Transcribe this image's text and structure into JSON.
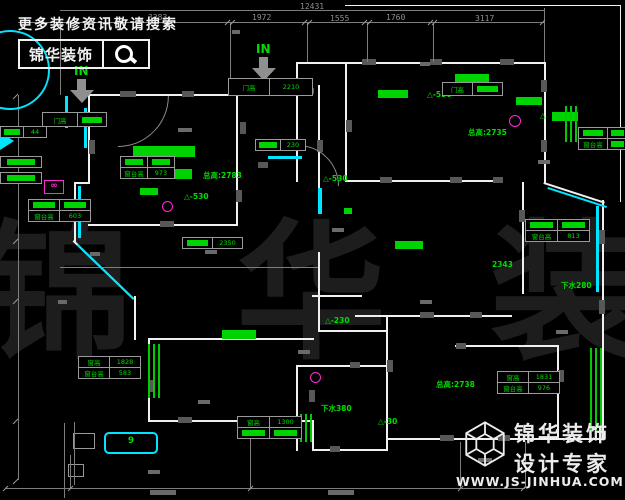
{
  "page": {
    "title": "户型平面图",
    "width": 625,
    "height": 500
  },
  "colors": {
    "background": "#000000",
    "wall": "#f0f0f0",
    "annotation_green": "#00dd00",
    "window_cyan": "#00e5ff",
    "symbol_magenta": "#ff2bd6",
    "dim_gray": "#8f8f8f"
  },
  "promo": {
    "line1": "更多装修资讯敬请搜索",
    "logo_text": "锦华装饰",
    "icon": "search-icon"
  },
  "brand": {
    "name": "锦华装饰",
    "tagline": "设计专家",
    "url": "WWW.JS-JINHUA.COM",
    "icon": "cube-logo-icon"
  },
  "watermark": {
    "text": "锦 华 装 饰"
  },
  "arrows": [
    {
      "label": "IN",
      "tx": 74,
      "ty": 64,
      "ax": 70,
      "ay": 79
    },
    {
      "label": "IN",
      "tx": 256,
      "ty": 42,
      "ax": 252,
      "ay": 57
    }
  ],
  "dims": {
    "labels": [
      {
        "t": "12431",
        "x": 300,
        "y": 2
      },
      {
        "t": "3283",
        "x": 148,
        "y": 13
      },
      {
        "t": "1972",
        "x": 252,
        "y": 13
      },
      {
        "t": "1555",
        "x": 330,
        "y": 14
      },
      {
        "t": "1760",
        "x": 386,
        "y": 13
      },
      {
        "t": "3117",
        "x": 475,
        "y": 14
      }
    ],
    "lines": [
      [
        60,
        10,
        484,
        1
      ],
      [
        18,
        22,
        526,
        1
      ],
      [
        60,
        22,
        1,
        73
      ],
      [
        230,
        22,
        1,
        58
      ],
      [
        307,
        22,
        1,
        40
      ],
      [
        367,
        22,
        1,
        40
      ],
      [
        433,
        22,
        1,
        40
      ],
      [
        544,
        8,
        1,
        54
      ],
      [
        18,
        95,
        1,
        385
      ],
      [
        5,
        488,
        520,
        1
      ],
      [
        250,
        428,
        1,
        60
      ],
      [
        460,
        442,
        1,
        46
      ],
      [
        70,
        455,
        1,
        33
      ],
      [
        525,
        442,
        1,
        46
      ],
      [
        74,
        422,
        1,
        63
      ],
      [
        64,
        423,
        1,
        75
      ],
      [
        60,
        267,
        258,
        1
      ]
    ],
    "ticks": [
      [
        58,
        19
      ],
      [
        227,
        19
      ],
      [
        232,
        19
      ],
      [
        304,
        19
      ],
      [
        309,
        19
      ],
      [
        364,
        19
      ],
      [
        369,
        19
      ],
      [
        430,
        19
      ],
      [
        434,
        19
      ],
      [
        542,
        19
      ],
      [
        5,
        485
      ],
      [
        70,
        485
      ],
      [
        250,
        485
      ],
      [
        460,
        485
      ],
      [
        523,
        485
      ],
      [
        15,
        93
      ],
      [
        15,
        178
      ],
      [
        15,
        238
      ],
      [
        15,
        298
      ],
      [
        15,
        418
      ],
      [
        15,
        478
      ]
    ],
    "smudges": [
      [
        178,
        128,
        14,
        4
      ],
      [
        205,
        250,
        12,
        4
      ],
      [
        90,
        252,
        10,
        4
      ],
      [
        332,
        228,
        12,
        4
      ],
      [
        538,
        160,
        12,
        4
      ],
      [
        420,
        300,
        12,
        4
      ],
      [
        298,
        350,
        12,
        4
      ],
      [
        198,
        400,
        12,
        4
      ],
      [
        478,
        458,
        14,
        4
      ],
      [
        148,
        470,
        12,
        4
      ],
      [
        556,
        330,
        12,
        4
      ],
      [
        58,
        300,
        9,
        4
      ],
      [
        150,
        490,
        26,
        5
      ],
      [
        328,
        490,
        26,
        5
      ],
      [
        420,
        62,
        10,
        4
      ],
      [
        232,
        30,
        8,
        4
      ]
    ]
  },
  "plan": {
    "walls": [
      [
        88,
        94,
        150,
        2
      ],
      [
        236,
        80,
        2,
        16
      ],
      [
        236,
        80,
        62,
        2
      ],
      [
        296,
        62,
        2,
        23
      ],
      [
        296,
        62,
        250,
        2
      ],
      [
        544,
        62,
        2,
        122
      ],
      [
        544,
        182,
        64,
        2,
        18
      ],
      [
        602,
        200,
        2,
        240
      ],
      [
        386,
        438,
        218,
        2
      ],
      [
        386,
        332,
        2,
        119
      ],
      [
        150,
        420,
        164,
        2
      ],
      [
        312,
        420,
        2,
        31
      ],
      [
        312,
        449,
        76,
        2
      ],
      [
        148,
        340,
        2,
        82
      ],
      [
        134,
        296,
        2,
        44
      ],
      [
        74,
        240,
        84,
        2,
        44
      ],
      [
        74,
        182,
        2,
        60
      ],
      [
        74,
        182,
        16,
        2
      ],
      [
        88,
        94,
        2,
        90
      ],
      [
        236,
        94,
        2,
        132
      ],
      [
        88,
        224,
        150,
        2
      ],
      [
        318,
        85,
        2,
        122
      ],
      [
        318,
        252,
        2,
        80
      ],
      [
        296,
        85,
        2,
        97
      ],
      [
        345,
        62,
        2,
        120
      ],
      [
        345,
        180,
        157,
        2
      ],
      [
        522,
        182,
        2,
        112
      ],
      [
        355,
        315,
        157,
        2
      ],
      [
        312,
        295,
        50,
        2
      ],
      [
        455,
        345,
        104,
        2
      ],
      [
        557,
        345,
        2,
        95
      ],
      [
        296,
        365,
        92,
        2
      ],
      [
        296,
        365,
        2,
        86
      ],
      [
        148,
        338,
        166,
        2
      ],
      [
        318,
        330,
        70,
        2
      ],
      [
        386,
        315,
        2,
        19
      ],
      [
        345,
        5,
        276,
        1
      ],
      [
        620,
        5,
        1,
        197
      ]
    ],
    "grays": [
      [
        120,
        91,
        16,
        6
      ],
      [
        182,
        91,
        12,
        6
      ],
      [
        240,
        122,
        6,
        12
      ],
      [
        302,
        88,
        12,
        6
      ],
      [
        362,
        59,
        14,
        6
      ],
      [
        430,
        59,
        12,
        6
      ],
      [
        500,
        59,
        14,
        6
      ],
      [
        541,
        80,
        6,
        12
      ],
      [
        541,
        140,
        6,
        12
      ],
      [
        599,
        230,
        6,
        14
      ],
      [
        599,
        300,
        6,
        14
      ],
      [
        160,
        221,
        14,
        6
      ],
      [
        89,
        140,
        6,
        14
      ],
      [
        258,
        162,
        10,
        6
      ],
      [
        317,
        140,
        6,
        12
      ],
      [
        346,
        120,
        6,
        12
      ],
      [
        380,
        177,
        12,
        6
      ],
      [
        450,
        177,
        12,
        6
      ],
      [
        493,
        177,
        10,
        6
      ],
      [
        519,
        210,
        6,
        12
      ],
      [
        420,
        312,
        14,
        6
      ],
      [
        470,
        312,
        12,
        6
      ],
      [
        387,
        360,
        6,
        12
      ],
      [
        440,
        435,
        14,
        6
      ],
      [
        498,
        435,
        12,
        6
      ],
      [
        178,
        417,
        14,
        6
      ],
      [
        248,
        417,
        12,
        6
      ],
      [
        149,
        380,
        6,
        12
      ],
      [
        309,
        390,
        6,
        12
      ],
      [
        350,
        362,
        10,
        6
      ],
      [
        330,
        446,
        10,
        6
      ],
      [
        558,
        370,
        6,
        12
      ],
      [
        236,
        190,
        6,
        12
      ],
      [
        456,
        343,
        10,
        6
      ]
    ],
    "arcs": [
      [
        190,
        96,
        100,
        135
      ],
      [
        298,
        128,
        80,
        45
      ]
    ],
    "boxes": [
      [
        73,
        433,
        20,
        14
      ],
      [
        68,
        464,
        14,
        11
      ]
    ]
  },
  "greens": {
    "texts": [
      {
        "t": "总高:2783",
        "x": 203,
        "y": 170
      },
      {
        "t": "总高:2735",
        "x": 468,
        "y": 127
      },
      {
        "t": "总高:2738",
        "x": 436,
        "y": 379
      },
      {
        "t": "△-530",
        "x": 184,
        "y": 192
      },
      {
        "t": "△-530",
        "x": 427,
        "y": 90
      },
      {
        "t": "△-530",
        "x": 323,
        "y": 174
      },
      {
        "t": "△-230",
        "x": 325,
        "y": 316
      },
      {
        "t": "△-30",
        "x": 378,
        "y": 417
      },
      {
        "t": "下水280",
        "x": 561,
        "y": 280
      },
      {
        "t": "2343",
        "x": 492,
        "y": 260
      },
      {
        "t": "下水380",
        "x": 321,
        "y": 403
      },
      {
        "t": "△",
        "x": 540,
        "y": 111
      }
    ],
    "fills": [
      [
        133,
        146,
        62,
        11
      ],
      [
        120,
        169,
        72,
        10
      ],
      [
        378,
        90,
        30,
        8
      ],
      [
        516,
        97,
        26,
        8
      ],
      [
        455,
        74,
        34,
        8
      ],
      [
        395,
        241,
        28,
        8
      ],
      [
        222,
        330,
        34,
        9
      ],
      [
        552,
        112,
        26,
        9
      ],
      [
        140,
        188,
        18,
        7
      ],
      [
        344,
        208,
        8,
        6
      ]
    ],
    "hatches": [
      [
        565,
        106,
        12,
        36
      ],
      [
        590,
        348,
        13,
        90
      ],
      [
        148,
        344,
        13,
        54
      ],
      [
        300,
        414,
        12,
        28
      ]
    ]
  },
  "cyans": {
    "lines": [
      [
        84,
        108,
        3,
        40
      ],
      [
        78,
        186,
        3,
        52
      ],
      [
        78,
        244,
        78,
        2,
        44
      ],
      [
        268,
        156,
        34,
        3
      ],
      [
        318,
        188,
        4,
        26
      ],
      [
        548,
        187,
        62,
        2,
        18
      ],
      [
        596,
        206,
        3,
        86
      ],
      [
        65,
        96,
        3,
        32
      ]
    ],
    "box": {
      "x": 104,
      "y": 432,
      "w": 50,
      "h": 18,
      "label": "9"
    },
    "arc": {
      "cx": 8,
      "cy": 68,
      "r": 38
    },
    "tri": {
      "x": 0,
      "y": 132
    }
  },
  "magentas": [
    {
      "x": 44,
      "y": 180,
      "w": 18,
      "h": 12,
      "t": "∞"
    },
    {
      "x": 509,
      "y": 115,
      "w": 10,
      "h": 10
    },
    {
      "x": 310,
      "y": 372,
      "w": 9,
      "h": 9
    },
    {
      "x": 162,
      "y": 201,
      "w": 9,
      "h": 9
    }
  ],
  "tables": [
    {
      "x": 228,
      "y": 78,
      "cols": [
        40,
        42
      ],
      "rh": 16,
      "rows": [
        [
          {
            "t": "门高"
          },
          {
            "t": "2210"
          }
        ]
      ]
    },
    {
      "x": 42,
      "y": 112,
      "cols": [
        34,
        28
      ],
      "rh": 13,
      "rows": [
        [
          {
            "t": "门高"
          },
          {
            "f": 1
          }
        ]
      ]
    },
    {
      "x": 120,
      "y": 156,
      "cols": [
        26,
        26
      ],
      "rows": [
        [
          {
            "f": 1
          },
          {
            "f": 1
          }
        ],
        [
          {
            "t": "窗台高"
          },
          {
            "t": "973"
          }
        ]
      ]
    },
    {
      "x": 28,
      "y": 199,
      "cols": [
        30,
        30
      ],
      "rows": [
        [
          {
            "f": 1
          },
          {
            "f": 1
          }
        ],
        [
          {
            "t": "窗台高"
          },
          {
            "t": "603"
          }
        ]
      ]
    },
    {
      "x": 0,
      "y": 126,
      "cols": [
        22,
        22
      ],
      "rows": [
        [
          {
            "f": 1
          },
          {
            "t": "44"
          }
        ]
      ]
    },
    {
      "x": 255,
      "y": 139,
      "cols": [
        24,
        24
      ],
      "rows": [
        [
          {
            "f": 1
          },
          {
            "t": "230"
          }
        ]
      ]
    },
    {
      "x": 78,
      "y": 356,
      "cols": [
        30,
        30
      ],
      "rows": [
        [
          {
            "t": "窗高"
          },
          {
            "t": "1828"
          }
        ],
        [
          {
            "t": "窗台高"
          },
          {
            "t": "583"
          }
        ]
      ]
    },
    {
      "x": 237,
      "y": 416,
      "cols": [
        31,
        31
      ],
      "rows": [
        [
          {
            "t": "窗高"
          },
          {
            "t": "1300"
          }
        ],
        [
          {
            "f": 1
          },
          {
            "f": 1
          }
        ]
      ]
    },
    {
      "x": 497,
      "y": 371,
      "cols": [
        30,
        30
      ],
      "rows": [
        [
          {
            "t": "窗高"
          },
          {
            "t": "1831"
          }
        ],
        [
          {
            "t": "窗台高"
          },
          {
            "t": "976"
          }
        ]
      ]
    },
    {
      "x": 525,
      "y": 219,
      "cols": [
        31,
        31
      ],
      "rows": [
        [
          {
            "f": 1
          },
          {
            "f": 1
          }
        ],
        [
          {
            "t": "窗台高"
          },
          {
            "t": "813"
          }
        ]
      ]
    },
    {
      "x": 578,
      "y": 127,
      "cols": [
        28,
        19
      ],
      "rows": [
        [
          {
            "f": 1
          },
          {
            "f": 1
          }
        ],
        [
          {
            "t": "窗台高"
          },
          {
            "f": 1
          }
        ]
      ]
    },
    {
      "x": 442,
      "y": 82,
      "cols": [
        29,
        29
      ],
      "rh": 12,
      "rows": [
        [
          {
            "t": "门高"
          },
          {
            "f": 1
          }
        ]
      ]
    },
    {
      "x": 182,
      "y": 237,
      "cols": [
        29,
        29
      ],
      "rows": [
        [
          {
            "f": 1
          },
          {
            "t": "2350"
          }
        ]
      ]
    },
    {
      "x": 0,
      "y": 156,
      "cols": [
        40
      ],
      "rows": [
        [
          {
            "f": 1
          }
        ]
      ]
    },
    {
      "x": 0,
      "y": 172,
      "cols": [
        40
      ],
      "rows": [
        [
          {
            "f": 1
          }
        ]
      ]
    }
  ]
}
